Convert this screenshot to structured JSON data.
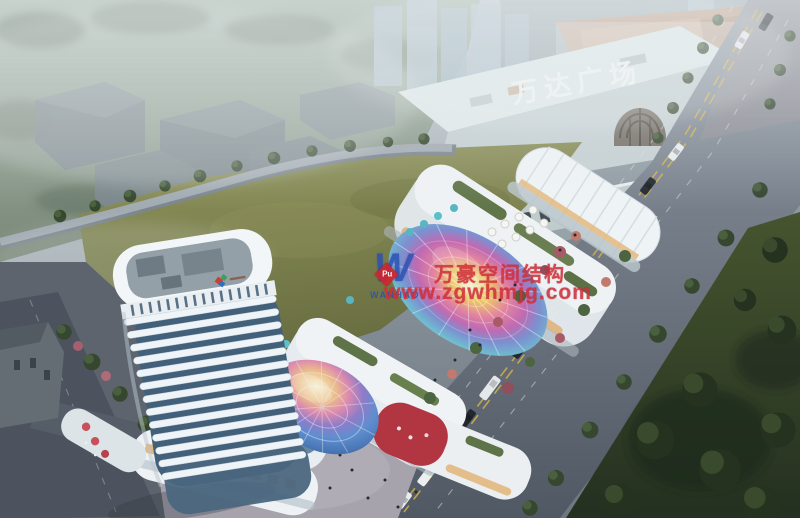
{
  "signage": {
    "mall_roof_sign": "万达广场"
  },
  "watermark": {
    "logo_letter": "W",
    "logo_diamond_text": "Pu",
    "logo_name": "WANHAO",
    "company": "万豪空间结构",
    "website": "www.zgwhmjg.com"
  },
  "colors": {
    "watermark_red": "#d0303a",
    "watermark_logo_blue": "#2b50b4",
    "mall_sign_white": "#f2f6f5",
    "field_green": "#7d814f",
    "lawn_green": "#31402a",
    "road_gray": "#6b7480",
    "tower_glass_blue": "#43607a",
    "tower_band_white": "#eef4f7",
    "canopy_rainbow": [
      "#f2ecc8",
      "#ecc767",
      "#e2849f",
      "#c06ab2",
      "#7c90d0",
      "#6fb9cf"
    ],
    "dome_rainbow": [
      "#f4eecc",
      "#ecbf8a",
      "#dd8aae",
      "#8f7cc8",
      "#5f8ed0",
      "#3f6ba6"
    ]
  }
}
